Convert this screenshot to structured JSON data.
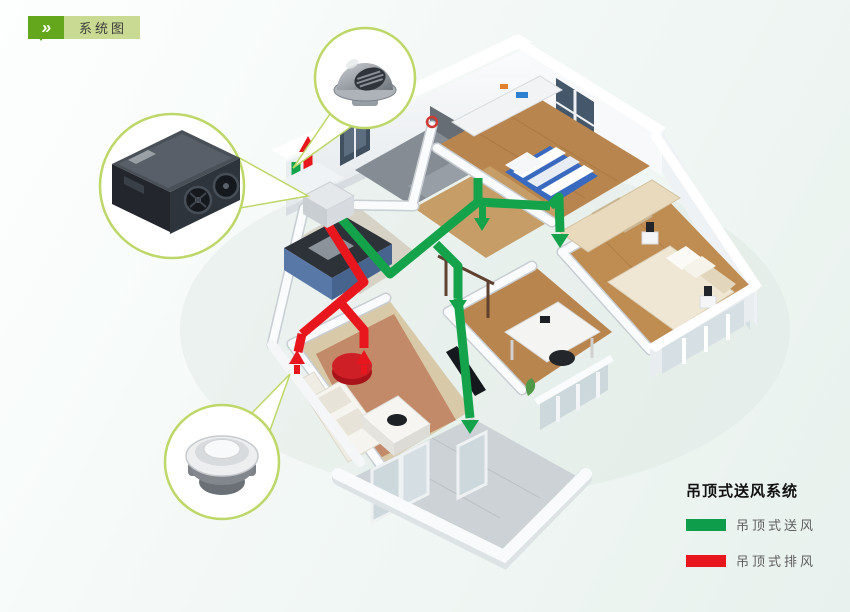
{
  "badge": {
    "chevron_icon": "»",
    "label": "系统图"
  },
  "legend": {
    "title": "吊顶式送风系统",
    "items": [
      {
        "label": "吊顶式送风",
        "color": "#0e9d4a"
      },
      {
        "label": "吊顶式排风",
        "color": "#e8171e"
      }
    ]
  },
  "diagram": {
    "supply_duct_color": "#14a34b",
    "exhaust_duct_color": "#e8171e",
    "callout_ring_color": "#bdd768",
    "callouts": [
      "wall-vent-cap",
      "heat-recovery-ventilator",
      "ceiling-exhaust-diffuser"
    ]
  }
}
